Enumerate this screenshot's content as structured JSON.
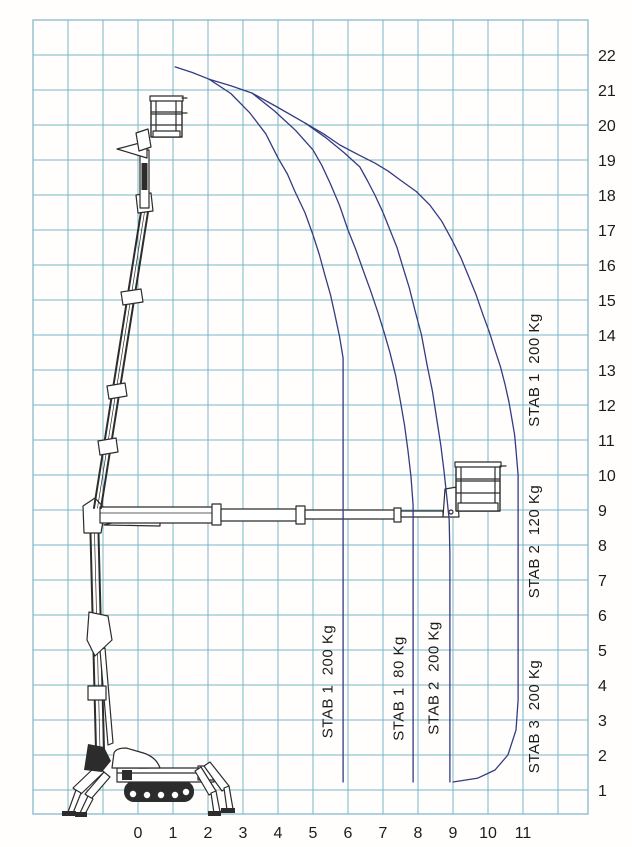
{
  "chart_data": {
    "type": "line",
    "title": "",
    "xlabel": "",
    "ylabel": "",
    "units": "m",
    "grid": true,
    "xlim": [
      -3,
      12.9
    ],
    "ylim": [
      0.3,
      23
    ],
    "x_ticks": [
      0,
      1,
      2,
      3,
      4,
      5,
      6,
      7,
      8,
      9,
      10,
      11
    ],
    "y_ticks": [
      1,
      2,
      3,
      4,
      5,
      6,
      7,
      8,
      9,
      10,
      11,
      12,
      13,
      14,
      15,
      16,
      17,
      18,
      19,
      20,
      21,
      22
    ],
    "colors": {
      "grid": "#7ab5c6",
      "curve": "#333c82",
      "text": "#1c1c1c",
      "machine": "#2c2c2c",
      "background": "#fffefc"
    },
    "series": [
      {
        "name": "STAB 1 200 Kg limit",
        "points": [
          [
            2.03,
            21.31
          ],
          [
            2.65,
            20.9
          ],
          [
            3.2,
            20.34
          ],
          [
            3.65,
            19.75
          ],
          [
            4.0,
            19.06
          ],
          [
            4.27,
            18.6
          ],
          [
            4.49,
            18.09
          ],
          [
            4.77,
            17.5
          ],
          [
            5.0,
            16.86
          ],
          [
            5.18,
            16.3
          ],
          [
            5.34,
            15.71
          ],
          [
            5.5,
            15.15
          ],
          [
            5.63,
            14.57
          ],
          [
            5.76,
            13.95
          ],
          [
            5.86,
            13.34
          ],
          [
            5.86,
            1.23
          ]
        ]
      },
      {
        "name": "STAB 1 80 Kg limit",
        "points": [
          [
            3.26,
            20.91
          ],
          [
            3.9,
            20.4
          ],
          [
            4.5,
            19.85
          ],
          [
            5.0,
            19.29
          ],
          [
            5.25,
            18.85
          ],
          [
            5.49,
            18.34
          ],
          [
            5.76,
            17.7
          ],
          [
            6.0,
            17.0
          ],
          [
            6.22,
            16.45
          ],
          [
            6.43,
            15.86
          ],
          [
            6.65,
            15.25
          ],
          [
            6.86,
            14.63
          ],
          [
            7.04,
            14.05
          ],
          [
            7.2,
            13.49
          ],
          [
            7.36,
            12.85
          ],
          [
            7.49,
            12.14
          ],
          [
            7.61,
            11.45
          ],
          [
            7.71,
            10.71
          ],
          [
            7.8,
            9.95
          ],
          [
            7.86,
            9.14
          ],
          [
            7.86,
            1.23
          ]
        ]
      },
      {
        "name": "STAB 2 200 Kg limit",
        "points": [
          [
            4.77,
            20.06
          ],
          [
            5.35,
            19.65
          ],
          [
            5.9,
            19.2
          ],
          [
            6.34,
            18.8
          ],
          [
            6.56,
            18.4
          ],
          [
            6.77,
            18.0
          ],
          [
            7.0,
            17.5
          ],
          [
            7.2,
            17.0
          ],
          [
            7.4,
            16.5
          ],
          [
            7.57,
            15.94
          ],
          [
            7.75,
            15.35
          ],
          [
            7.91,
            14.71
          ],
          [
            8.1,
            14.0
          ],
          [
            8.26,
            13.14
          ],
          [
            8.41,
            12.4
          ],
          [
            8.54,
            11.57
          ],
          [
            8.65,
            10.85
          ],
          [
            8.74,
            10.14
          ],
          [
            8.82,
            9.4
          ],
          [
            8.89,
            8.71
          ],
          [
            8.91,
            7.71
          ],
          [
            8.91,
            1.23
          ]
        ]
      },
      {
        "name": "Outer envelope (STAB 1 200 / STAB 2 120 / STAB 3 200)",
        "points": [
          [
            1.06,
            21.66
          ],
          [
            1.55,
            21.5
          ],
          [
            2.03,
            21.31
          ],
          [
            2.65,
            21.12
          ],
          [
            3.26,
            20.91
          ],
          [
            4.0,
            20.5
          ],
          [
            4.77,
            20.06
          ],
          [
            5.3,
            19.75
          ],
          [
            5.77,
            19.43
          ],
          [
            6.3,
            19.15
          ],
          [
            6.77,
            18.91
          ],
          [
            7.15,
            18.68
          ],
          [
            7.49,
            18.43
          ],
          [
            7.95,
            18.1
          ],
          [
            8.34,
            17.71
          ],
          [
            8.68,
            17.25
          ],
          [
            8.97,
            16.71
          ],
          [
            9.22,
            16.22
          ],
          [
            9.43,
            15.71
          ],
          [
            9.66,
            15.15
          ],
          [
            9.86,
            14.57
          ],
          [
            10.04,
            14.08
          ],
          [
            10.2,
            13.57
          ],
          [
            10.36,
            13.08
          ],
          [
            10.49,
            12.57
          ],
          [
            10.6,
            12.08
          ],
          [
            10.69,
            11.57
          ],
          [
            10.76,
            11.15
          ],
          [
            10.8,
            10.71
          ],
          [
            10.86,
            10.0
          ],
          [
            10.86,
            3.57
          ],
          [
            10.8,
            2.71
          ],
          [
            10.57,
            2.0
          ],
          [
            10.2,
            1.57
          ],
          [
            9.71,
            1.34
          ],
          [
            9.0,
            1.23
          ]
        ]
      }
    ],
    "annotations": [
      {
        "text": "STAB 1  200 Kg",
        "x": 5.55,
        "y": 4.1,
        "rotate": -90
      },
      {
        "text": "STAB 1  80 Kg",
        "x": 7.58,
        "y": 3.9,
        "rotate": -90
      },
      {
        "text": "STAB 2  200 Kg",
        "x": 8.58,
        "y": 4.2,
        "rotate": -90
      },
      {
        "text": "STAB 1  200 Kg",
        "x": 11.45,
        "y": 13.0,
        "rotate": -90
      },
      {
        "text": "STAB 2  120 Kg",
        "x": 11.45,
        "y": 8.1,
        "rotate": -90
      },
      {
        "text": "STAB 3  200 Kg",
        "x": 11.45,
        "y": 3.1,
        "rotate": -90
      }
    ]
  }
}
